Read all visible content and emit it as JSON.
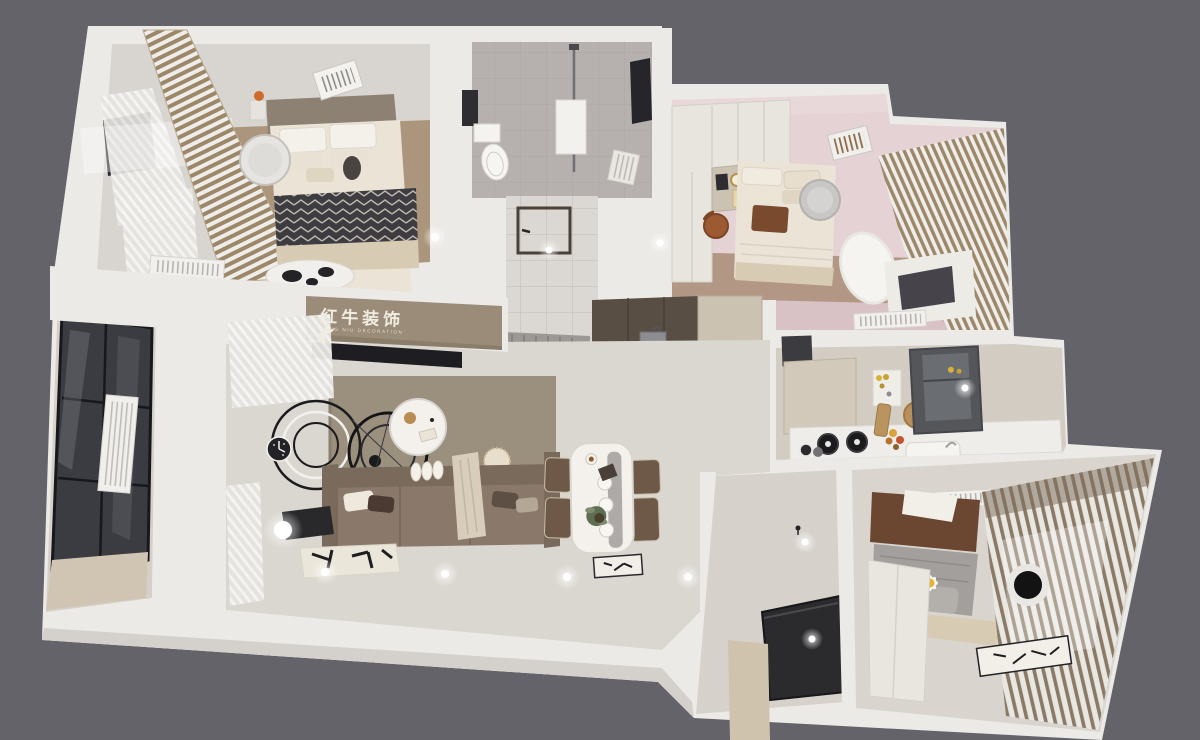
{
  "logo": {
    "brand_cn": "红牛装饰",
    "brand_en": "HONG NIU DECORATION",
    "registered_mark": "®"
  },
  "palette": {
    "bg": "#64636a",
    "wall": "#eceae7",
    "wall-shade": "#d4d1cd",
    "floor": "#dad6d0",
    "floor-warm": "#cfc8be",
    "wood": "#a5896f",
    "tile": "#b6b1ae",
    "pink": "#e4d2d5",
    "pink-deep": "#d9c2c6",
    "taupe": "#9a8c79",
    "accent": "#9b8f7e",
    "sofa": "#8a796b",
    "sofa-dark": "#796a5c",
    "dark": "#232226",
    "glass": "#3b3c41",
    "steel": "#54565a",
    "curtain-tan": "#9c8768",
    "linen": "#eae3d6",
    "beige": "#d8cbb4",
    "brown": "#6b4731",
    "leather": "#9c5a33",
    "walnut": "#584e44",
    "cream": "#cbc2b1",
    "marble": "#f4f1ec",
    "gray-blanket": "#a29f9c",
    "logo-text": "#f0ece1",
    "daisy-yellow": "#e7b42d"
  }
}
